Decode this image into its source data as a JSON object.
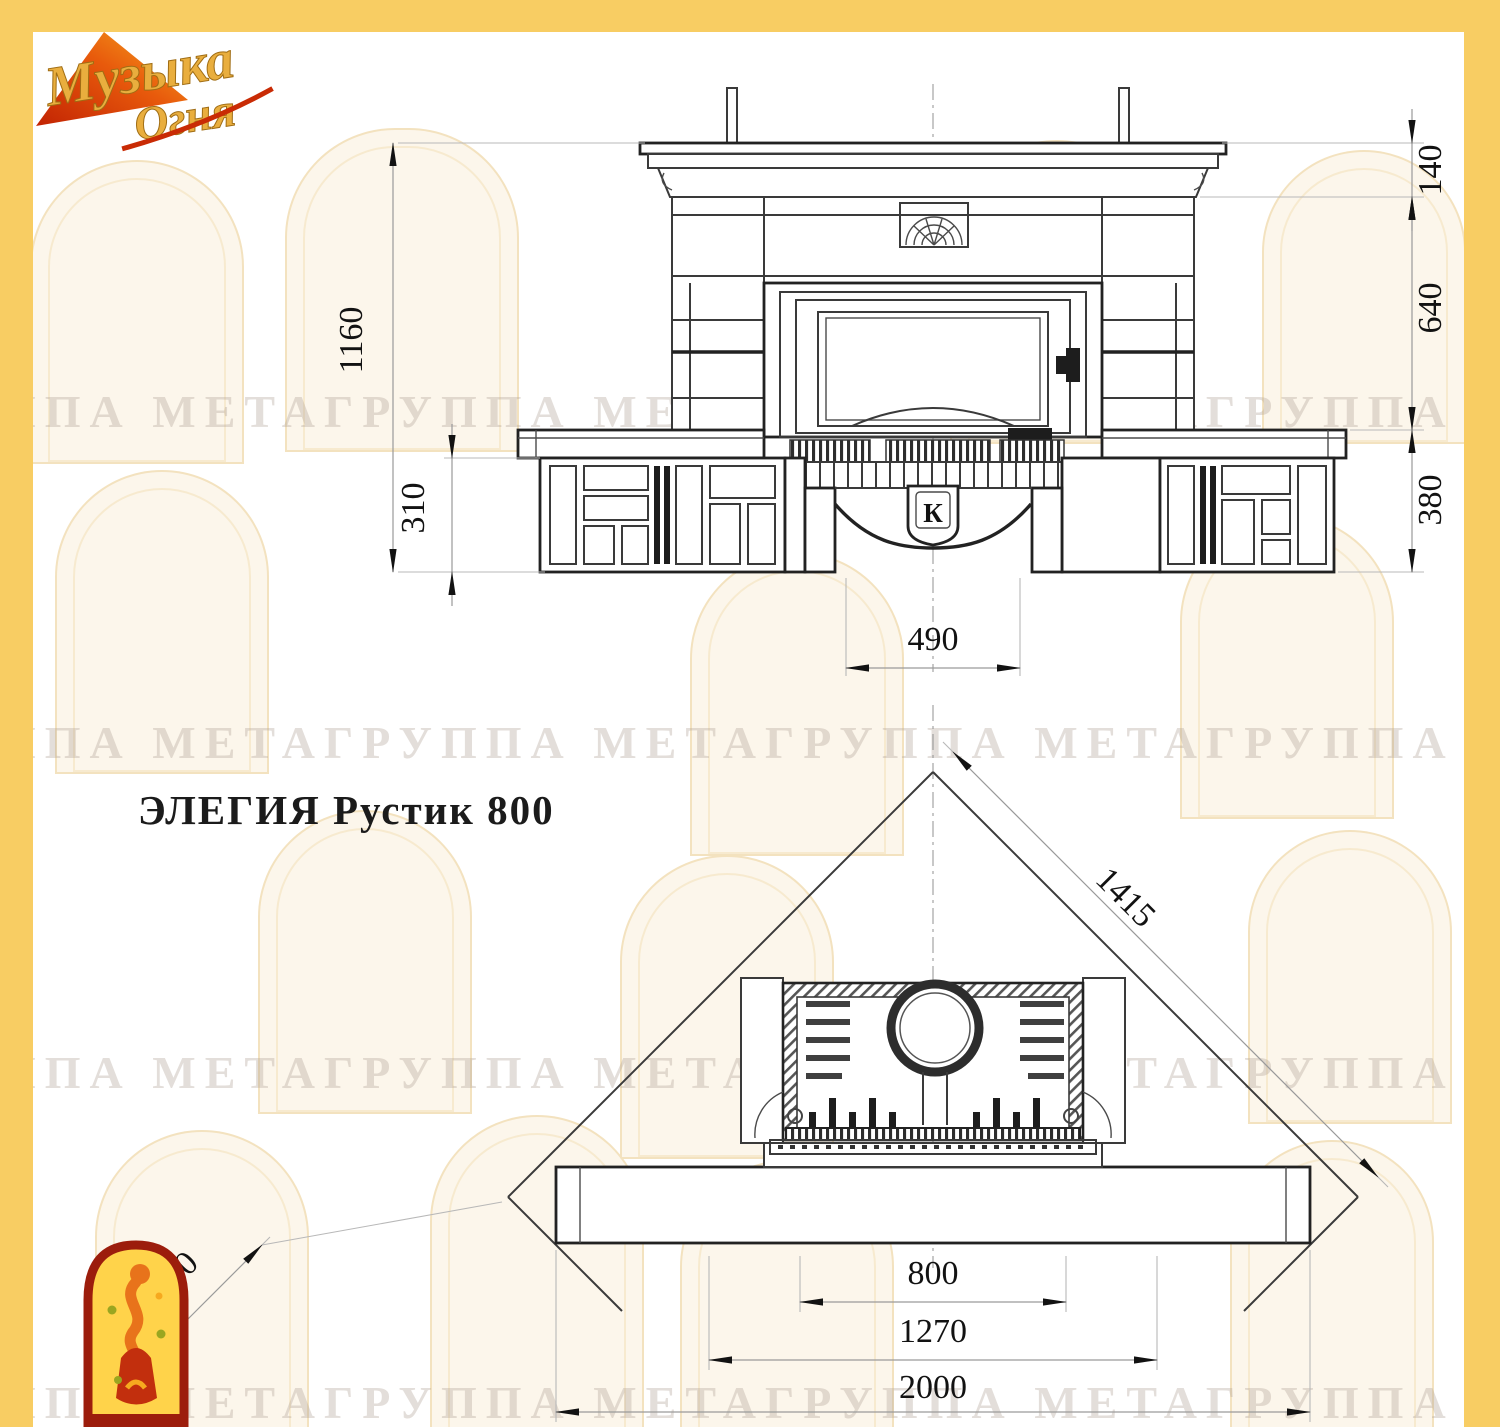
{
  "window": {
    "title": "ЭЛЕГИЯ Рустик 800"
  },
  "brand": {
    "logo_line1": "Музыка",
    "logo_line2": "Огня"
  },
  "watermark": {
    "row_text": "ППА МЕТАГРУППА МЕТАГРУППА МЕТАГРУППА МЕТАГРУППА МЕТА"
  },
  "palette": {
    "frame_yellow": "#F8CD63",
    "logo_gold": "#E9AE3E",
    "logo_red": "#C22F0D",
    "line_dark": "#222222"
  },
  "front_view": {
    "name": "front elevation of fireplace",
    "firebox_emblem": "К",
    "dims": {
      "total_height": "1160",
      "bench_front_height": "310",
      "base_opening_width": "490",
      "mantel_height": "140",
      "middle_height": "640",
      "bench_height": "380"
    }
  },
  "plan_view": {
    "name": "corner installation plan",
    "dims": {
      "diagonal_wall": "1415",
      "side_wall": "470",
      "firebox_width": "800",
      "inner_width": "1270",
      "overall_width": "2000"
    }
  }
}
